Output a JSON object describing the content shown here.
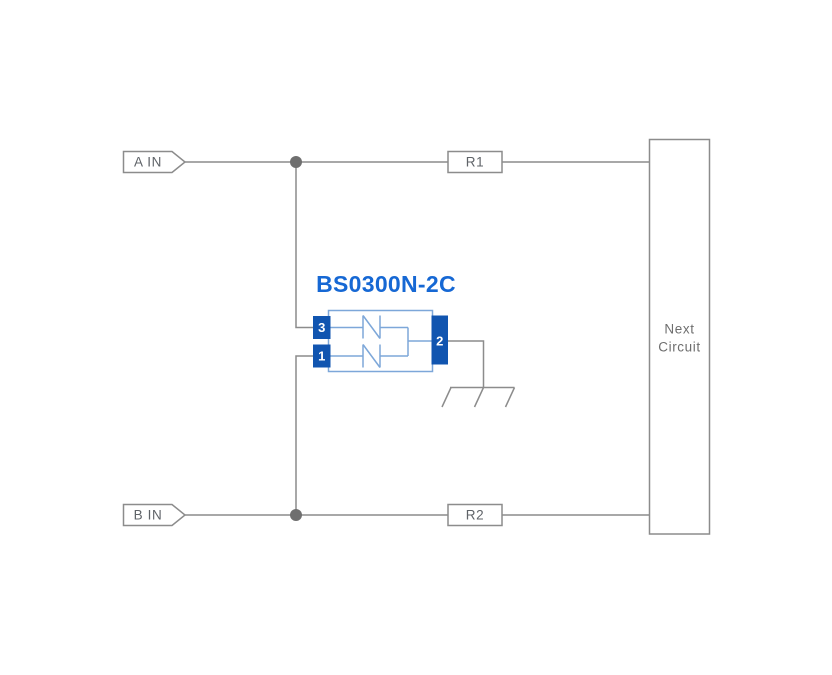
{
  "diagram": {
    "component": {
      "title": "BS0300N-2C",
      "pins": {
        "p3": "3",
        "p1": "1",
        "p2": "2"
      }
    },
    "inputs": {
      "a": "A IN",
      "b": "B IN"
    },
    "resistors": {
      "r1": "R1",
      "r2": "R2"
    },
    "next_circuit": {
      "line1": "Next",
      "line2": "Circuit"
    },
    "colors": {
      "wire": "#8c8c8c",
      "junction_dot": "#6f6f6f",
      "pin_blue": "#1155b0",
      "title_blue": "#1668d4",
      "body_outline": "#7da7d9",
      "label_text": "#5f6368",
      "background": "#ffffff"
    }
  }
}
